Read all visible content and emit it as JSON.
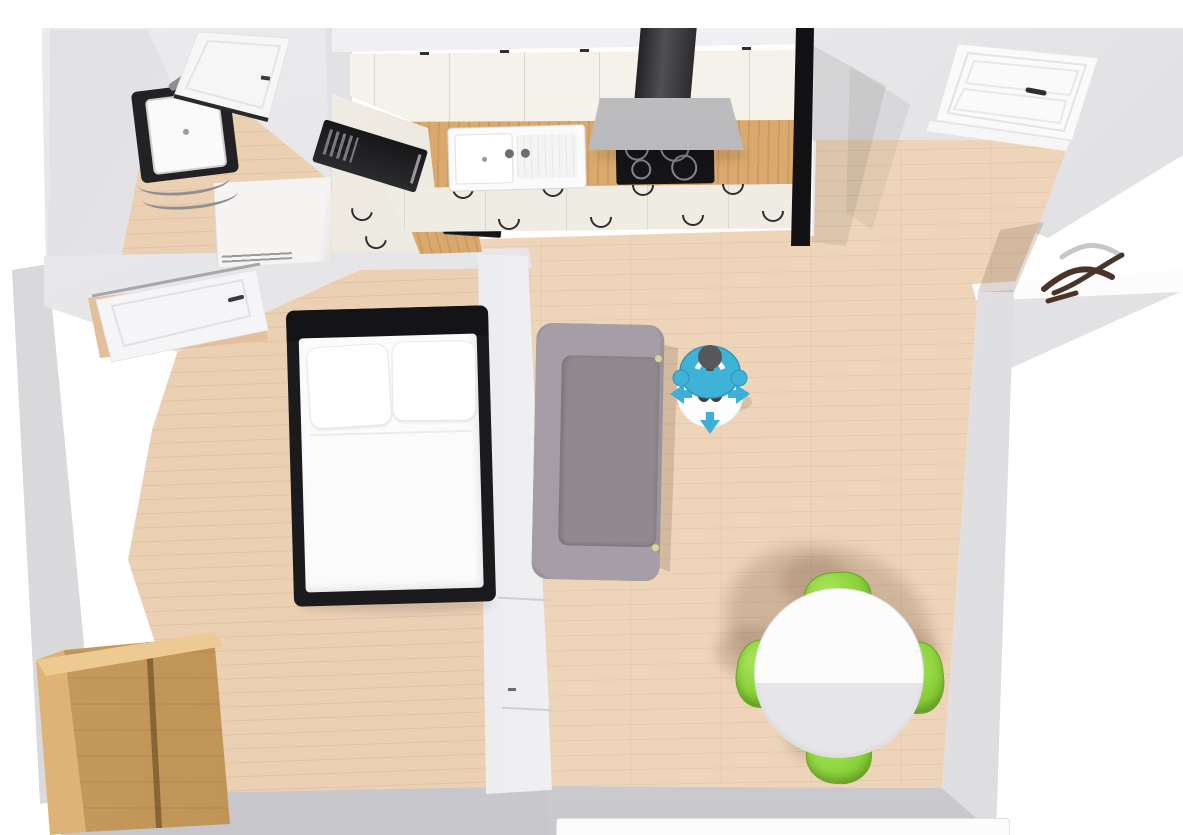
{
  "scene": {
    "view": "3d-floor-plan-top-down",
    "rooms": [
      {
        "name": "bathroom",
        "position": "top-left",
        "furniture": [
          "wall-mounted square sink on black vanity",
          "chrome faucet",
          "towel rails",
          "white washing machine",
          "white interior door (top-right, ajar)"
        ]
      },
      {
        "name": "kitchen",
        "position": "top-center",
        "furniture": [
          "cream upper cabinet run",
          "oak wood countertop",
          "white double sink with two fixtures",
          "black 4-burner cooktop",
          "stainless extractor hood with dark chimney",
          "black microwave on left return",
          "cream base cabinets with dark bow handles",
          "black-framed glass partition at right end",
          "black counter inset on left return"
        ]
      },
      {
        "name": "hallway",
        "position": "top-right",
        "furniture": [
          "white panelled entry door with handle",
          "dark wood branch coat stand",
          "wall alcove at right"
        ]
      },
      {
        "name": "bedroom",
        "position": "bottom-left",
        "furniture": [
          "double bed, black frame, white duvet, two white pillows",
          "two-door oak wardrobe in corner",
          "white panelled door on top wall",
          "door on living-room divider wall"
        ]
      },
      {
        "name": "living-room",
        "position": "center-right",
        "furniture": [
          "gray three-seat sofa against divider wall",
          "round white dining table",
          "four green shell chairs",
          "window with white sill on bottom wall"
        ]
      }
    ],
    "avatar": {
      "type": "person-top-view-camera-marker",
      "appearance": "figure with dark gray head, teal shirt, standing on white disc",
      "controls": [
        "move-left-arrow",
        "move-right-arrow",
        "move-down-arrow"
      ],
      "location": "living-room near kitchen"
    },
    "lighting": "soft shadows cast toward upper-left from person, table, chairs, partition and hood"
  },
  "colors": {
    "wall": "#e3e3e6",
    "wall_light": "#f1f1f3",
    "wall_dark": "#cfcfd3",
    "floor_wood": "#eed5ba",
    "floor_wood_warm": "#ebd0b4",
    "counter_wood": "#d9a86d",
    "cabinet_cream": "#f1eee5",
    "appliance_black": "#151517",
    "hood_gray": "#a7a7a9",
    "sofa_gray": "#9c949c",
    "cushion_gray": "#908990",
    "chair_green": "#8bd23a",
    "chair_green_dark": "#6fae27",
    "table_white": "#fcfcfd",
    "table_shade": "#e6e6e9",
    "avatar_teal": "#3fb2d8",
    "avatar_teal_dark": "#2e95b7",
    "avatar_head_gray": "#575759",
    "bed_frame": "#1b1b1d",
    "bedding_white": "#fbfbfc",
    "wardrobe_front": "#bd9152",
    "wardrobe_side": "#dfb278",
    "door_white": "#f7f7f8",
    "partition_black": "#121214",
    "shadow_brown": "#755740"
  }
}
